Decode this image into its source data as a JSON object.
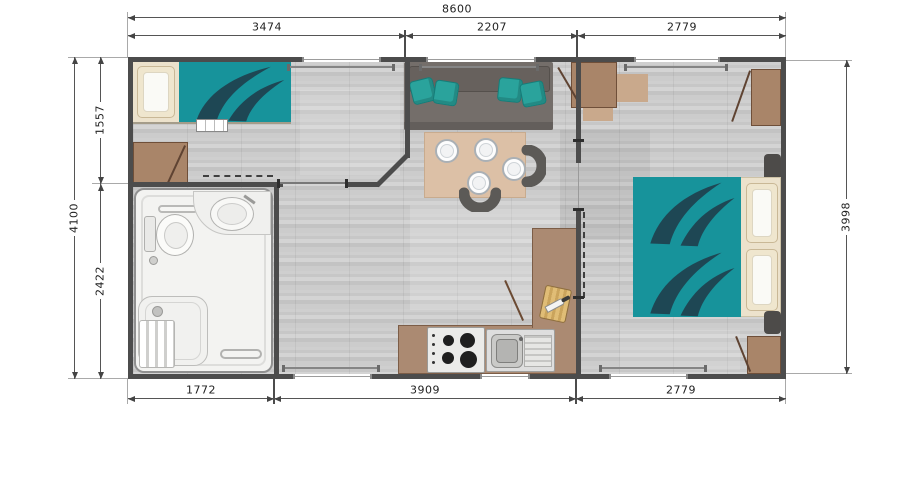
{
  "dimensions": {
    "top": {
      "overall": "8600",
      "segments": [
        "3474",
        "2207",
        "2779"
      ]
    },
    "left": {
      "overall": "4100",
      "segments": [
        "1557",
        "2422"
      ]
    },
    "right": {
      "overall": "3998"
    },
    "bottom": {
      "segments": [
        "1772",
        "3909",
        "2779"
      ]
    }
  },
  "palette": {
    "wall": "#4c4c4c",
    "floor_gray": "#c9c9c9",
    "bed_teal": "#17939b",
    "cushion_teal": "#2aa39c",
    "furniture_brown": "#a98569",
    "table_tan": "#dcc0a6",
    "bathroom_white": "#f3f3f1",
    "sofa_gray": "#6e6864",
    "dimension_text": "#222222"
  }
}
